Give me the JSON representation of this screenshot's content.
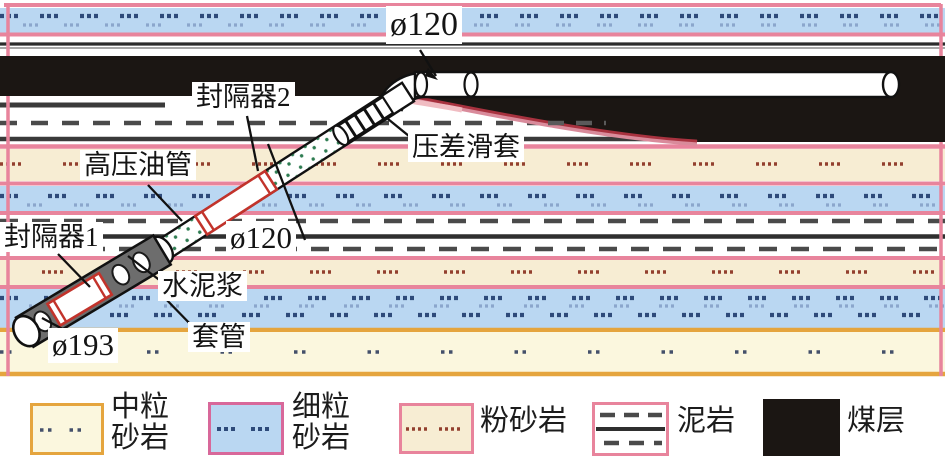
{
  "figure": {
    "type": "well-completion-geological-cross-section",
    "labels": {
      "dia_top": "ø120",
      "packer2": "封隔器2",
      "sliding_sleeve": "压差滑套",
      "hp_tubing": "高压油管",
      "packer1": "封隔器1",
      "dia_mid": "ø120",
      "cement": "水泥浆",
      "casing": "套管",
      "dia_casing": "ø193"
    },
    "colors": {
      "coal": "#1b1613",
      "fine_sandstone_fill": "#bad7f2",
      "siltstone_fill": "#f7edd3",
      "medium_sandstone_fill": "#fbf7de",
      "stratum_pink_border": "#e8849c",
      "stratum_orange_border": "#e5a53e",
      "packer_red": "#c2332b",
      "cement_dot_green": "#2f7d52",
      "casing_gray": "#6d6d6d",
      "coal_fringe_red": "#a8323f"
    }
  },
  "legend": {
    "items": [
      {
        "name": "medium-sandstone",
        "label_line1": "中粒",
        "label_line2": "砂岩",
        "fill": "#fbf7de",
        "border": "#e5a53e",
        "pattern": "dot-pairs"
      },
      {
        "name": "fine-sandstone",
        "label_line1": "细粒",
        "label_line2": "砂岩",
        "fill": "#bad7f2",
        "border": "#d8689a",
        "pattern": "dot-triples"
      },
      {
        "name": "siltstone",
        "label": "粉砂岩",
        "fill": "#f7edd3",
        "border": "#e8849c",
        "pattern": "dot-quads"
      },
      {
        "name": "mudstone",
        "label": "泥岩",
        "fill": "#ffffff",
        "border": "#e8849c",
        "pattern": "dashes-with-solid-line"
      },
      {
        "name": "coal-seam",
        "label": "煤层",
        "fill": "#1b1613",
        "border": "#1b1613",
        "pattern": "solid"
      }
    ]
  }
}
